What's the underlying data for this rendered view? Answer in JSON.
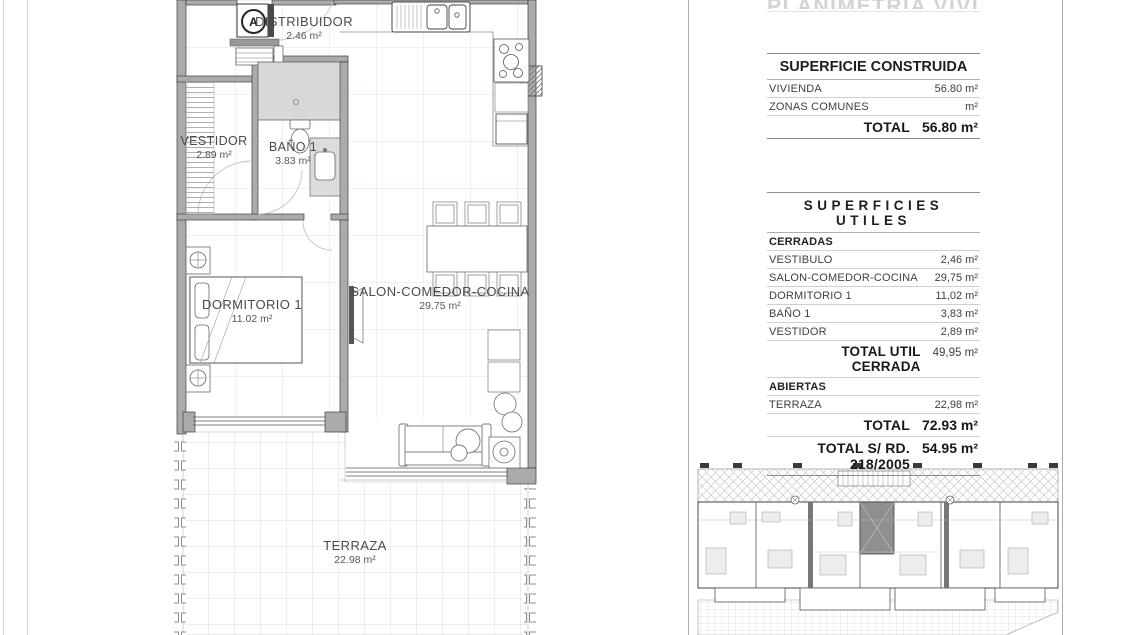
{
  "sheet": {
    "cropped_title": "PLANIMETRIA VIVIENDA",
    "entry_marker": "A"
  },
  "colors": {
    "wall_fill": "#ababab",
    "wall_stroke": "#3f3f3f",
    "floor_grid": "#e4e1d3",
    "terrace_grid": "#d6d3c6",
    "text_dark": "#3a3a3a",
    "rule_gray": "#cfcfcf",
    "cropped_title_gray": "#d3d3d3"
  },
  "plan": {
    "rooms": [
      {
        "name": "DISTRIBUIDOR",
        "area": "2.46 m²"
      },
      {
        "name": "VESTIDOR",
        "area": "2.89 m²"
      },
      {
        "name": "BAÑO 1",
        "area": "3.83 m²"
      },
      {
        "name": "DORMITORIO 1",
        "area": "11.02 m²"
      },
      {
        "name": "SALON-COMEDOR-COCINA",
        "area": "29.75 m²"
      },
      {
        "name": "TERRAZA",
        "area": "22.98 m²"
      }
    ]
  },
  "tables": {
    "construida": {
      "title": "SUPERFICIE CONSTRUIDA",
      "rows": [
        {
          "label": "VIVIENDA",
          "value": "56.80 m²"
        },
        {
          "label": "ZONAS COMUNES",
          "value": "m²"
        }
      ],
      "total": {
        "label": "TOTAL",
        "value": "56.80 m²"
      }
    },
    "utiles": {
      "title": "SUPERFICIES UTILES",
      "sections": [
        {
          "header": "CERRADAS",
          "rows": [
            {
              "label": "VESTIBULO",
              "value": "2,46 m²"
            },
            {
              "label": "SALON-COMEDOR-COCINA",
              "value": "29,75 m²"
            },
            {
              "label": "DORMITORIO 1",
              "value": "11,02 m²"
            },
            {
              "label": "BAÑO 1",
              "value": "3,83 m²"
            },
            {
              "label": "VESTIDOR",
              "value": "2,89 m²"
            }
          ],
          "total": {
            "label": "TOTAL UTIL CERRADA",
            "value": "49,95 m²"
          }
        },
        {
          "header": "ABIERTAS",
          "rows": [
            {
              "label": "TERRAZA",
              "value": "22,98 m²"
            }
          ]
        }
      ],
      "grand_total": {
        "label": "TOTAL",
        "value": "72.93 m²"
      },
      "regulation_total": {
        "label": "TOTAL S/ RD. 218/2005",
        "value": "54.95 m²"
      }
    }
  }
}
